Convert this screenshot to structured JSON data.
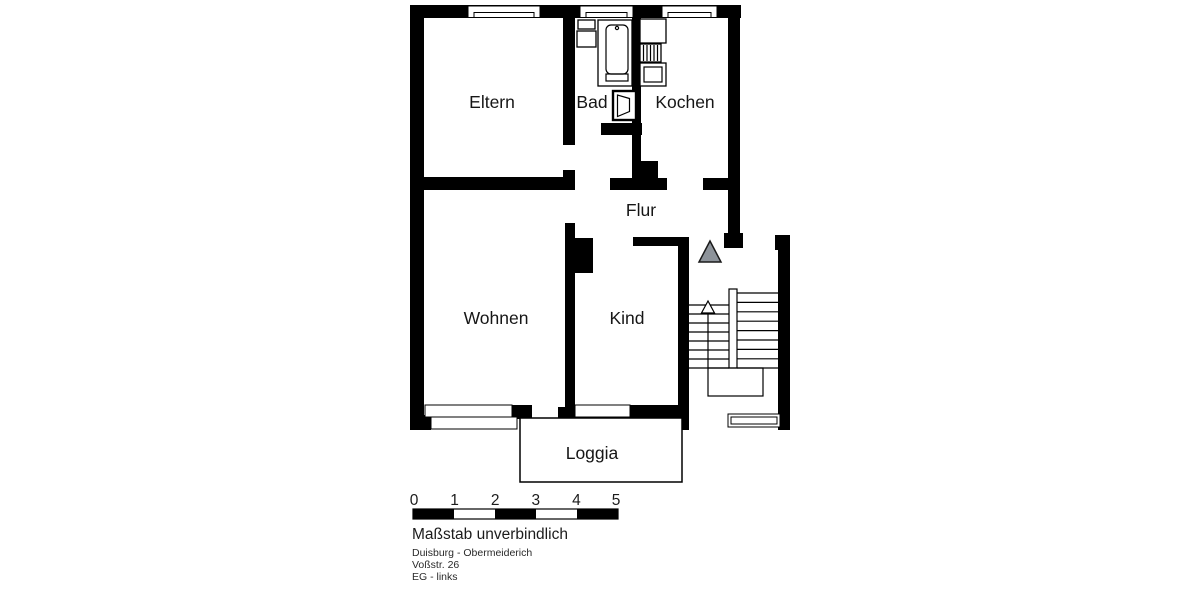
{
  "floorplan": {
    "rooms": {
      "eltern": "Eltern",
      "bad": "Bad",
      "kochen": "Kochen",
      "flur": "Flur",
      "wohnen": "Wohnen",
      "kind": "Kind",
      "loggia": "Loggia"
    },
    "scale_bar": {
      "ticks": [
        "0",
        "1",
        "2",
        "3",
        "4",
        "5"
      ],
      "caption": "Maßstab unverbindlich"
    },
    "address": {
      "city": "Duisburg - Obermeiderich",
      "street": "Voßstr. 26",
      "floor": "EG - links"
    },
    "colors": {
      "walls": "#000000",
      "entrance_marker": "#8d939a"
    }
  }
}
